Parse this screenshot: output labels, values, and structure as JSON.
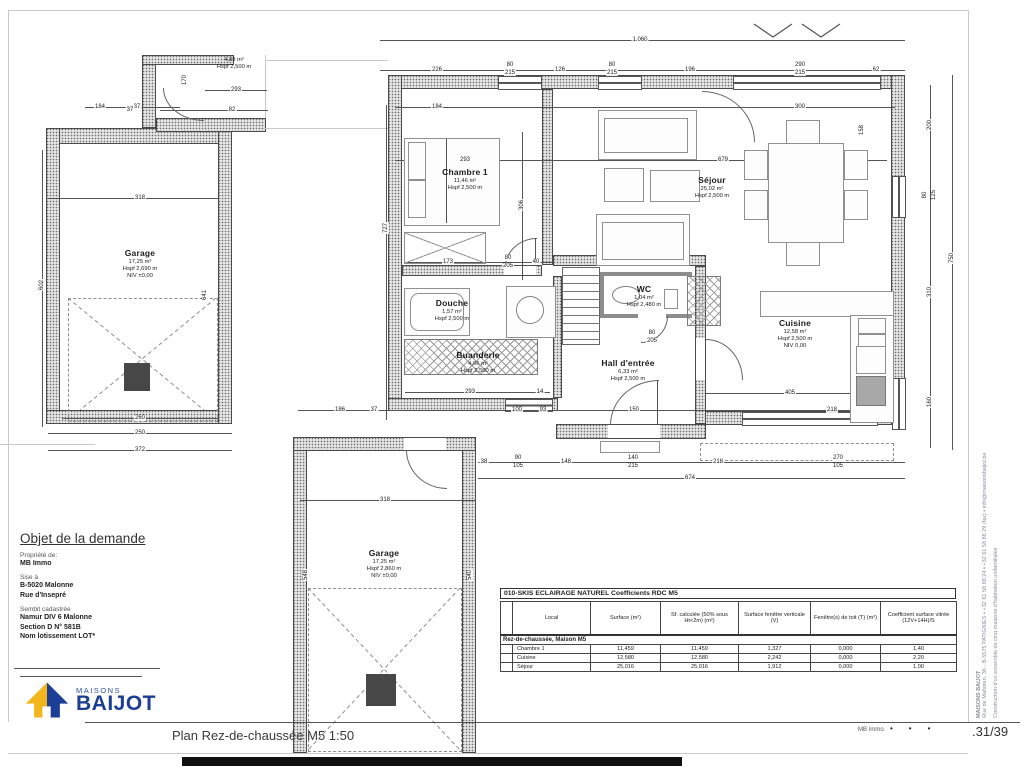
{
  "title_block": {
    "heading": "Objet de la demande",
    "owner_label": "Propriété de:",
    "owner": "MB Immo",
    "address_label": "Sise à",
    "address_line1": "B-5020 Malonne",
    "address_line2": "Rue d'Insepré",
    "cadastre_label": "Sembit cadastrée",
    "cadastre_line1": "Namur DIV 6 Malonne",
    "cadastre_line2": "Section D N° 581B",
    "cadastre_line3": "Nom lotissement LOT*"
  },
  "logo": {
    "top": "MAISONS",
    "name": "BAIJOT",
    "blue": "#1d3e96",
    "yellow": "#f2b51c"
  },
  "footer": {
    "title": "Plan Rez-de-chaussée M5 1:50",
    "owner": "MB Immo",
    "dots": "•••",
    "page": ".31/39"
  },
  "side_text": {
    "line1": "MAISONS BAIJOT",
    "line2": "Rue de Mahoten, 36 - B-5575 PATIGNIES • +32 61 58 88 24 • +32 61 58 88 29 (fax) • info@maisonsbaijot.be",
    "line3": "Construction d'un ensemble de cinq maisons d'habitation unifamiliales"
  },
  "table": {
    "title": "010-SKIS ECLAIRAGE NATUREL Coefficients RDC M5",
    "columns": [
      "Local",
      "Surface (m²)",
      "Sf. calculée (50% sous Ht<2m) (m²)",
      "Surface fenêtre verticale (V)",
      "Fenêtre(s) de toit (T)  (m²)",
      "Coefficient surface vitrée (12V+14H)/S"
    ],
    "section": "Rez-de-chaussée, Maison M5",
    "rows": [
      [
        "Chambre 1",
        "11,459",
        "11,459",
        "1,327",
        "0,000",
        "1,40"
      ],
      [
        "Cuisine",
        "12,580",
        "12,580",
        "2,242",
        "0,000",
        "2,20"
      ],
      [
        "Séjour",
        "25,016",
        "25,016",
        "1,912",
        "0,000",
        "1,00"
      ]
    ]
  },
  "plan": {
    "rooms": [
      {
        "name": "Garage",
        "area": "17,25 m²",
        "height": "Hspf 2,690 m",
        "level": "NIV ±0,00",
        "x": 140,
        "y": 248
      },
      {
        "name": "Chambre 1",
        "area": "11,46 m²",
        "height": "Hspf 2,500 m",
        "level": "",
        "x": 465,
        "y": 167
      },
      {
        "name": "Séjour",
        "area": "25,02 m²",
        "height": "Hspf 2,500 m",
        "level": "",
        "x": 712,
        "y": 175
      },
      {
        "name": "Douche",
        "area": "1,57 m²",
        "height": "Hspf 2,500 m",
        "level": "",
        "x": 452,
        "y": 298
      },
      {
        "name": "Buanderie",
        "area": "4,66 m²",
        "height": "Hspf 2,500 m",
        "level": "",
        "x": 478,
        "y": 350
      },
      {
        "name": "WC",
        "area": "1,04 m²",
        "height": "Hspf 2,480 m",
        "level": "",
        "x": 644,
        "y": 284
      },
      {
        "name": "Hall d'entrée",
        "area": "6,33 m²",
        "height": "Hspf 2,500 m",
        "level": "",
        "x": 628,
        "y": 358
      },
      {
        "name": "Cuisine",
        "area": "12,58 m²",
        "height": "Hspf 2,500 m",
        "level": "NIV 0,00",
        "x": 795,
        "y": 318
      },
      {
        "name": "Garage",
        "area": "17,25 m²",
        "height": "Hspf 2,860 m",
        "level": "NIV ±0,00",
        "x": 384,
        "y": 548
      },
      {
        "name": "",
        "area": "4,88 m²",
        "height": "Hspf 2,500 m",
        "level": "",
        "x": 234,
        "y": 56
      }
    ],
    "dim_labels": [
      {
        "t": "1.060",
        "x": 640,
        "y": 40
      },
      {
        "t": "226",
        "x": 437,
        "y": 70
      },
      {
        "t": "80",
        "x": 510,
        "y": 65
      },
      {
        "t": "215",
        "x": 510,
        "y": 73
      },
      {
        "t": "126",
        "x": 560,
        "y": 70
      },
      {
        "t": "80",
        "x": 612,
        "y": 65
      },
      {
        "t": "215",
        "x": 612,
        "y": 73
      },
      {
        "t": "196",
        "x": 690,
        "y": 70
      },
      {
        "t": "290",
        "x": 800,
        "y": 65
      },
      {
        "t": "215",
        "x": 800,
        "y": 73
      },
      {
        "t": "62",
        "x": 876,
        "y": 70
      },
      {
        "t": "200",
        "x": 930,
        "y": 125,
        "r": 1
      },
      {
        "t": "80",
        "x": 925,
        "y": 195,
        "r": 1
      },
      {
        "t": "125",
        "x": 934,
        "y": 195,
        "r": 1
      },
      {
        "t": "310",
        "x": 930,
        "y": 292,
        "r": 1
      },
      {
        "t": "160",
        "x": 930,
        "y": 402,
        "r": 1
      },
      {
        "t": "750",
        "x": 952,
        "y": 258,
        "r": 1
      },
      {
        "t": "38",
        "x": 484,
        "y": 462
      },
      {
        "t": "90",
        "x": 518,
        "y": 458
      },
      {
        "t": "105",
        "x": 518,
        "y": 466
      },
      {
        "t": "148",
        "x": 566,
        "y": 462
      },
      {
        "t": "140",
        "x": 633,
        "y": 458
      },
      {
        "t": "215",
        "x": 633,
        "y": 466
      },
      {
        "t": "218",
        "x": 718,
        "y": 462
      },
      {
        "t": "270",
        "x": 838,
        "y": 458
      },
      {
        "t": "105",
        "x": 838,
        "y": 466
      },
      {
        "t": "674",
        "x": 690,
        "y": 478
      },
      {
        "t": "184",
        "x": 437,
        "y": 107
      },
      {
        "t": "300",
        "x": 800,
        "y": 107
      },
      {
        "t": "158",
        "x": 862,
        "y": 130,
        "r": 1
      },
      {
        "t": "184",
        "x": 100,
        "y": 107
      },
      {
        "t": "37",
        "x": 137,
        "y": 107
      },
      {
        "t": "602",
        "x": 42,
        "y": 285,
        "r": 1
      },
      {
        "t": "318",
        "x": 140,
        "y": 198
      },
      {
        "t": "641",
        "x": 205,
        "y": 295,
        "r": 1
      },
      {
        "t": "260",
        "x": 140,
        "y": 418
      },
      {
        "t": "250",
        "x": 140,
        "y": 433
      },
      {
        "t": "372",
        "x": 140,
        "y": 450
      },
      {
        "t": "293",
        "x": 236,
        "y": 90
      },
      {
        "t": "82",
        "x": 232,
        "y": 110
      },
      {
        "t": "37",
        "x": 130,
        "y": 110
      },
      {
        "t": "170",
        "x": 185,
        "y": 80,
        "r": 1
      },
      {
        "t": "293",
        "x": 465,
        "y": 160
      },
      {
        "t": "679",
        "x": 723,
        "y": 160
      },
      {
        "t": "306",
        "x": 522,
        "y": 205,
        "r": 1
      },
      {
        "t": "727",
        "x": 386,
        "y": 228,
        "r": 1
      },
      {
        "t": "173",
        "x": 448,
        "y": 262
      },
      {
        "t": "80",
        "x": 508,
        "y": 258
      },
      {
        "t": "205",
        "x": 508,
        "y": 266
      },
      {
        "t": "40",
        "x": 536,
        "y": 262
      },
      {
        "t": "293",
        "x": 470,
        "y": 392
      },
      {
        "t": "14",
        "x": 540,
        "y": 392
      },
      {
        "t": "100",
        "x": 517,
        "y": 410
      },
      {
        "t": "93",
        "x": 543,
        "y": 410
      },
      {
        "t": "150",
        "x": 634,
        "y": 410
      },
      {
        "t": "218",
        "x": 832,
        "y": 410
      },
      {
        "t": "405",
        "x": 790,
        "y": 393
      },
      {
        "t": "80",
        "x": 652,
        "y": 333
      },
      {
        "t": "205",
        "x": 652,
        "y": 341
      },
      {
        "t": "186",
        "x": 340,
        "y": 410
      },
      {
        "t": "37",
        "x": 374,
        "y": 410
      },
      {
        "t": "318",
        "x": 385,
        "y": 500
      },
      {
        "t": "548",
        "x": 306,
        "y": 575,
        "r": 1
      },
      {
        "t": "540",
        "x": 470,
        "y": 575,
        "r": 1
      }
    ]
  }
}
